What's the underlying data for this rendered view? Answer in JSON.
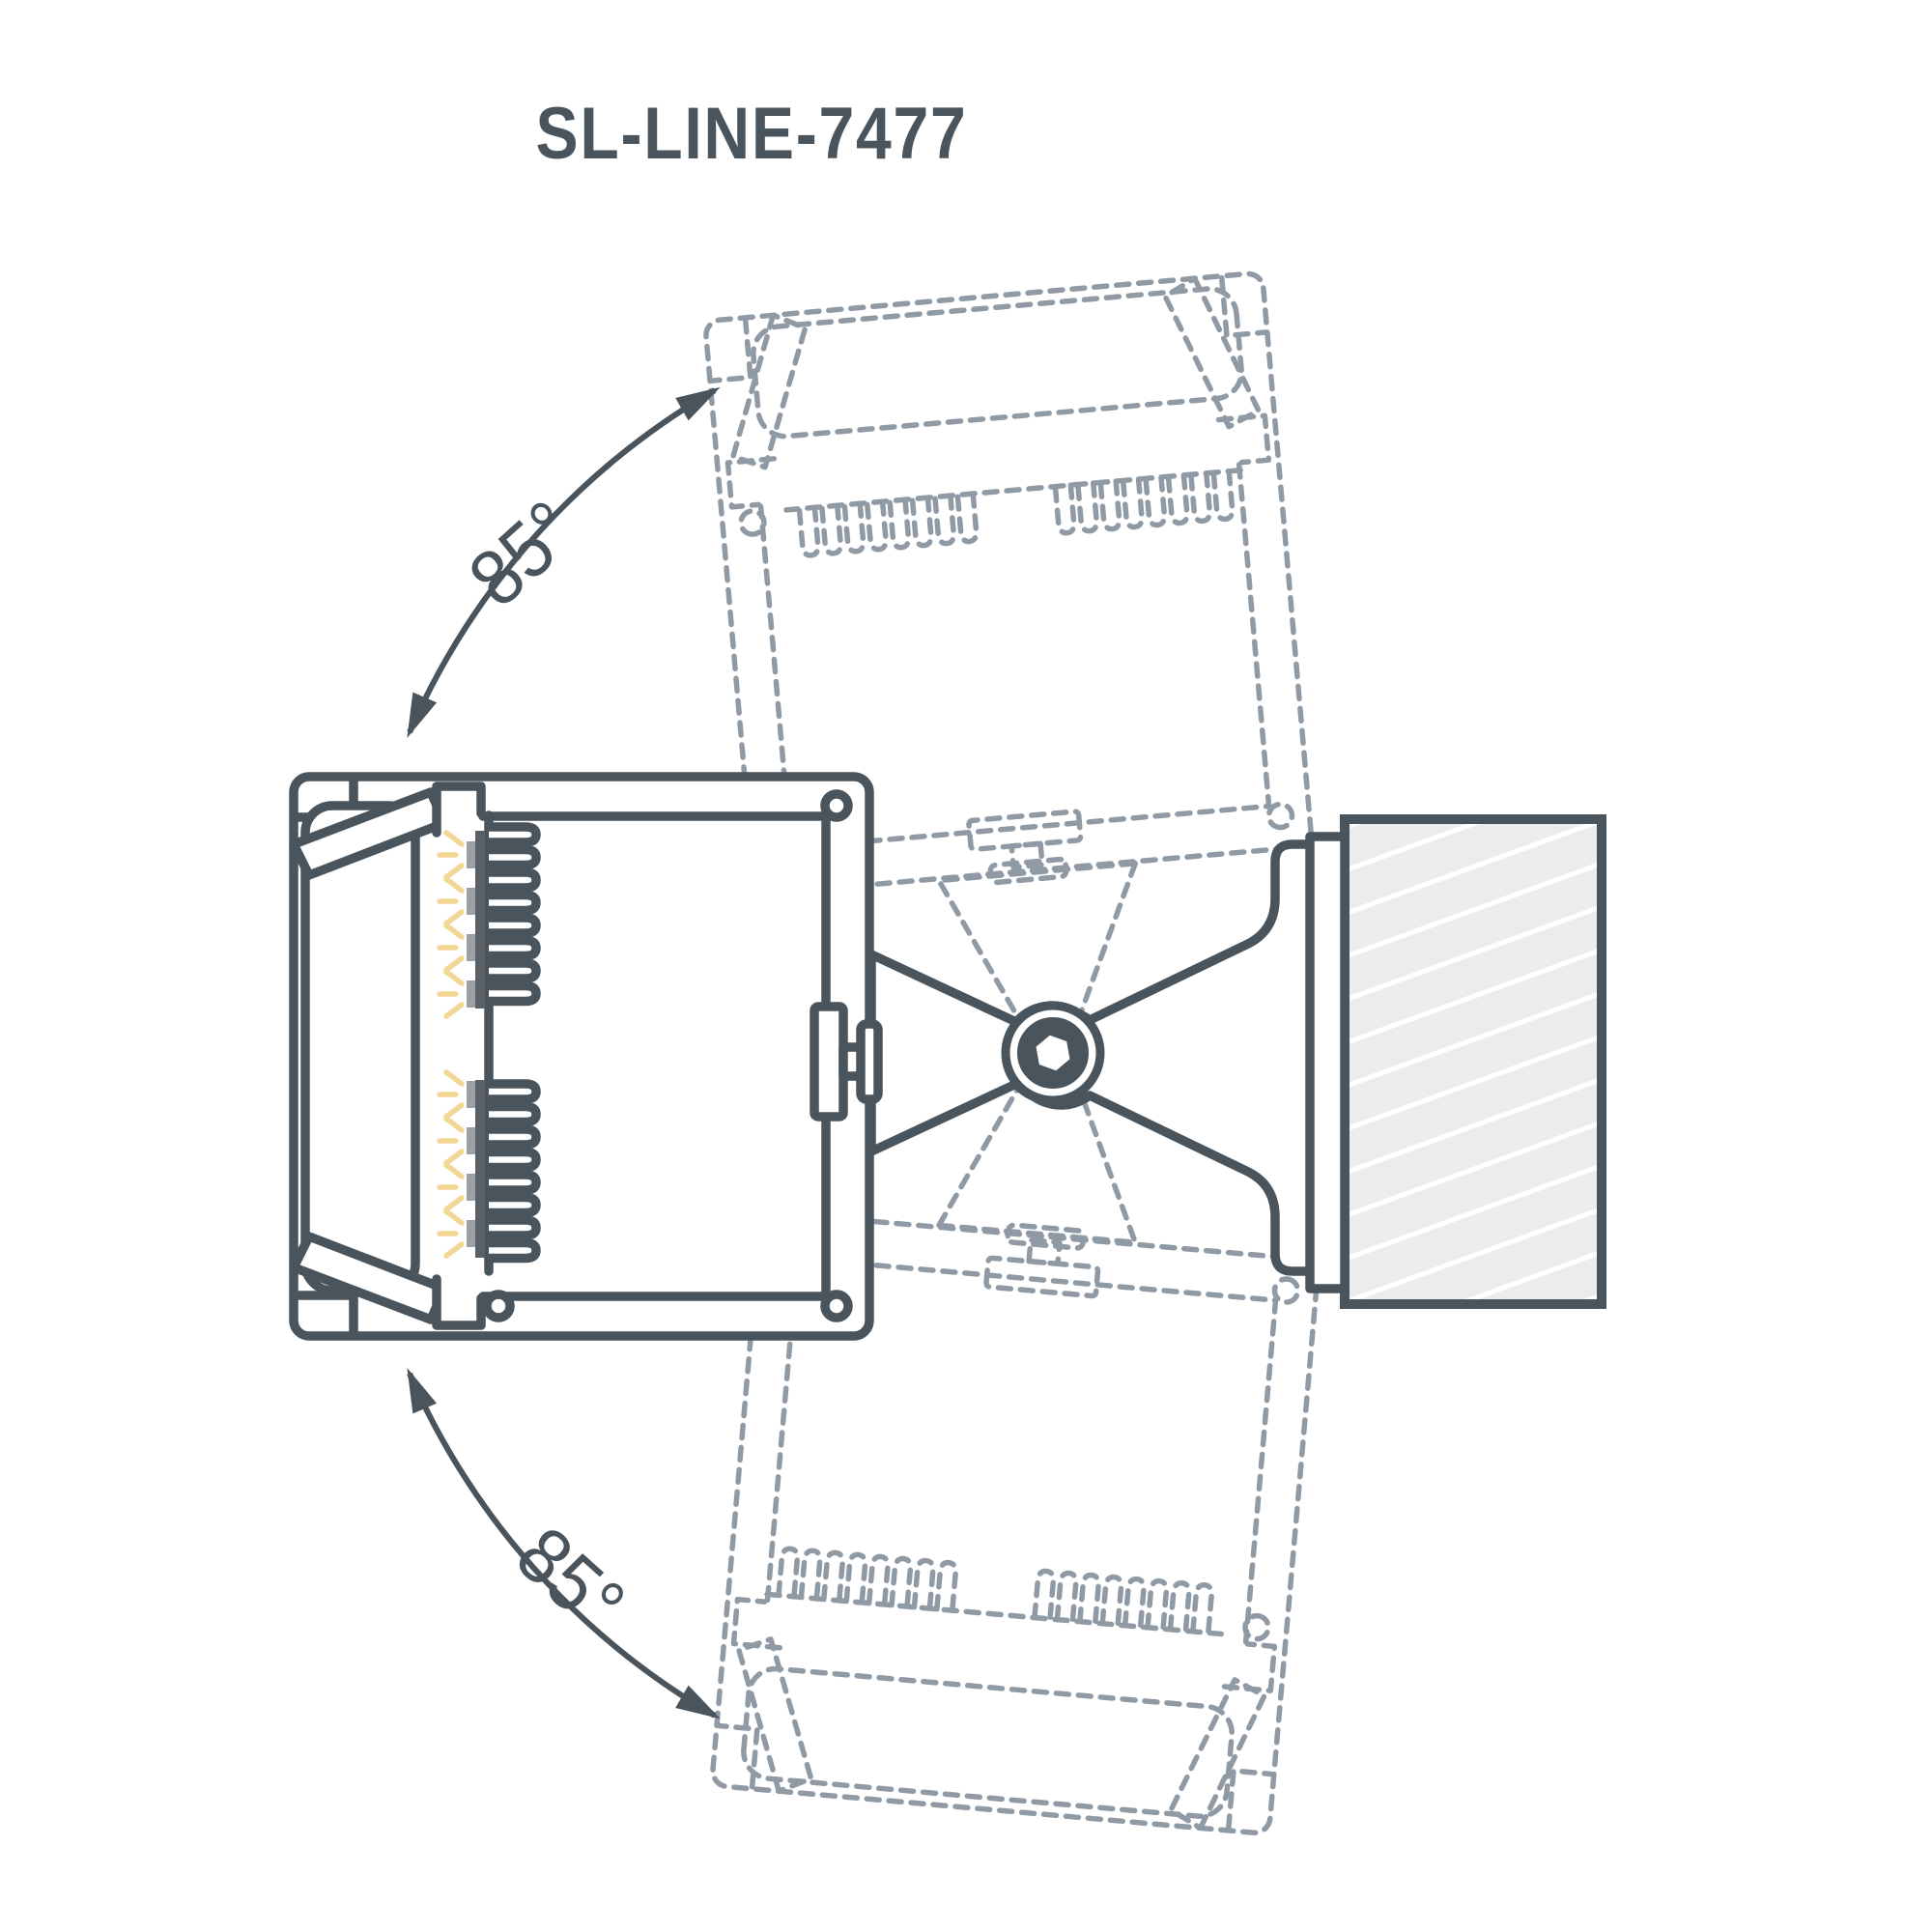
{
  "title": "SL-LINE-7477",
  "angles": {
    "top": "85°",
    "bottom": "85°"
  },
  "colors": {
    "line": "#4a545c",
    "ghost_line": "#8f9aa5",
    "led_glow": "#f2d795",
    "led_chip": "#9aa0a5",
    "led_board": "#596066",
    "wall_fill": "#ececec",
    "hatch_line": "#ffffff",
    "background": "#ffffff"
  },
  "diagram": {
    "rotation_up_label": "85°",
    "rotation_down_label": "85°"
  }
}
